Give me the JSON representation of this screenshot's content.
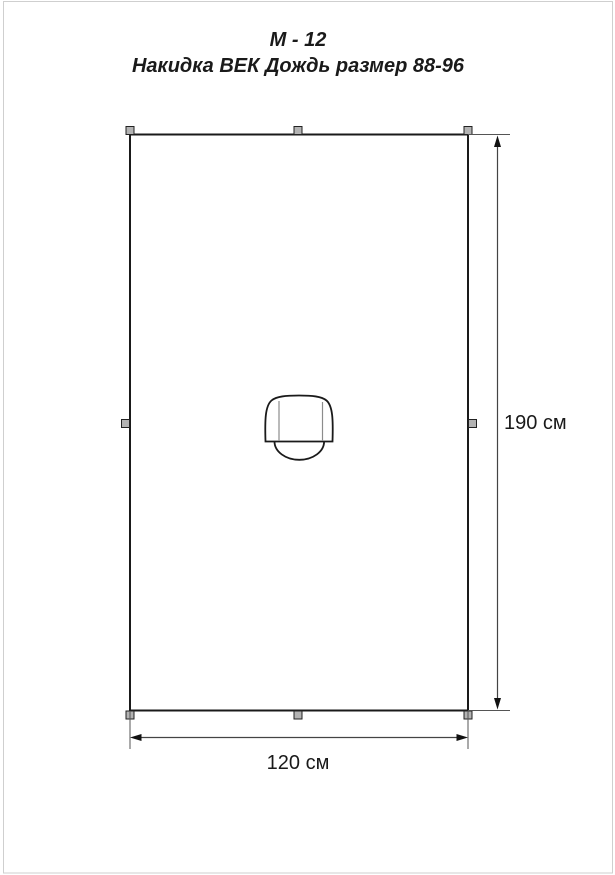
{
  "header": {
    "model_code": "М - 12",
    "product_title": "Накидка ВЕК Дождь размер 88-96"
  },
  "dimensions": {
    "height_label": "190 см",
    "width_label": "120 см"
  },
  "colors": {
    "background": "#ffffff",
    "outline": "#1a1a1a",
    "dimension_line": "#444444",
    "extension_line": "#555555",
    "hood_inner_line": "#8c8c8c",
    "snap_fill": "#b3b3b3",
    "page_frame": "#cfcfcf",
    "text": "#1a1a1a"
  }
}
